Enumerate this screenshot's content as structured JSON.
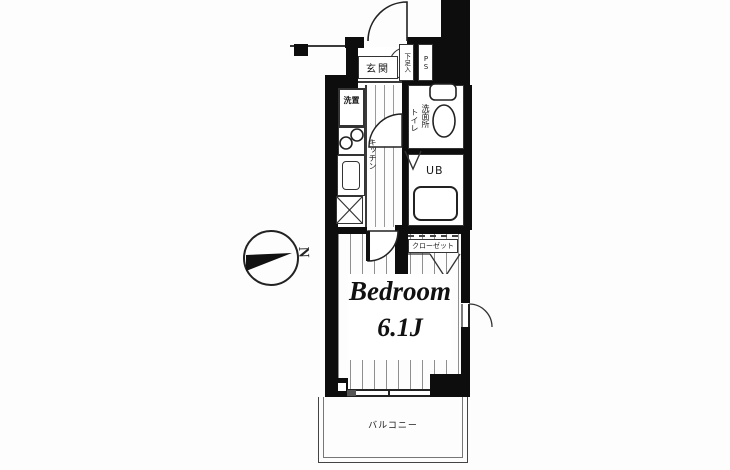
{
  "floorplan": {
    "room": {
      "name": "Bedroom",
      "size": "6.1J"
    },
    "labels": {
      "entrance": "玄関",
      "shoe_box": "下足入",
      "pipe_space": "PS",
      "washer_place": "洗置",
      "kitchen": "キッチン",
      "washroom": "洗面所",
      "toilet": "トイレ",
      "unit_bath": "UB",
      "closet": "クローゼット",
      "balcony": "バルコニー",
      "north": "N"
    },
    "colors": {
      "wall": "#0d0d0d",
      "line": "#333333",
      "floor": "#ffffff"
    }
  }
}
